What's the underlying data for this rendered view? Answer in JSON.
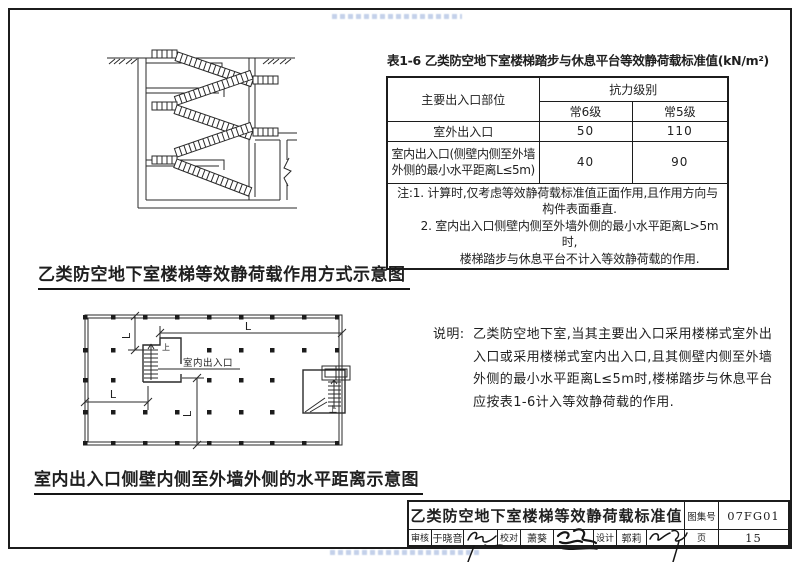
{
  "figures": {
    "section_caption": "乙类防空地下室楼梯等效静荷载作用方式示意图",
    "plan_caption": "室内出入口侧壁内侧至外墙外侧的水平距离示意图",
    "plan_entrance_label": "室内出入口",
    "up_label": "上",
    "dim_label": "L"
  },
  "table": {
    "title": "表1-6  乙类防空地下室楼梯踏步与休息平台等效静荷载标准值(kN/m²)",
    "header": {
      "part": "主要出入口部位",
      "group": "抗力级别",
      "grade6": "常6级",
      "grade5": "常5级"
    },
    "rows": [
      {
        "label": "室外出入口",
        "v6": "50",
        "v5": "110"
      },
      {
        "label_line1": "室内出入口(侧壁内侧至外墙",
        "label_line2": "外侧的最小水平距离L≤5m)",
        "v6": "40",
        "v5": "90"
      }
    ],
    "notes": {
      "line1": "注:1. 计算时,仅考虑等效静荷载标准值正面作用,且作用方向与",
      "line2": "构件表面垂直.",
      "line3": "2. 室内出入口侧壁内侧至外墙外侧的最小水平距离L>5m时,",
      "line4": "楼梯踏步与休息平台不计入等效静荷载的作用."
    }
  },
  "description": {
    "label": "说明:",
    "line1": "乙类防空地下室,当其主要出入口采用楼梯式室外出",
    "line2": "入口或采用楼梯式室内出入口,且其侧壁内侧至外墙",
    "line3": "外侧的最小水平距离L≤5m时,楼梯踏步与休息平台",
    "line4": "应按表1-6计入等效静荷载的作用."
  },
  "title_block": {
    "title": "乙类防空地下室楼梯等效静荷载标准值",
    "atlas_label": "图集号",
    "atlas_no": "07FG01",
    "page_label": "页",
    "page_no": "15",
    "reviewer_label": "审核",
    "reviewer_name": "于晓音",
    "checker_label": "校对",
    "checker_name": "萧葵",
    "designer_label": "设计",
    "designer_name": "郭莉"
  }
}
